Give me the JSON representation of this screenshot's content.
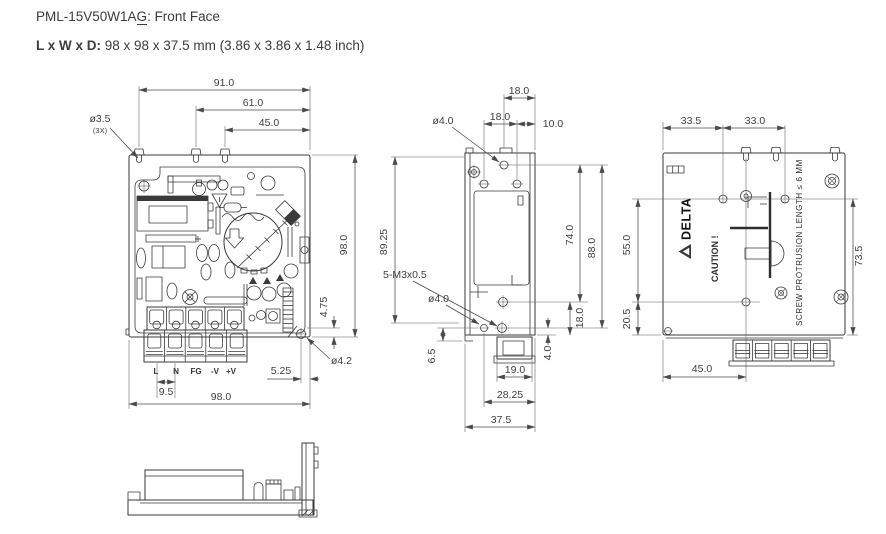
{
  "header": {
    "model": "PML-15V50W1A",
    "model_suffix": "G",
    "title_rest": ": Front Face",
    "size_label": "L x W x D:",
    "size_value": " 98 x 98 x 37.5 mm (3.86 x 3.86 x 1.48 inch)"
  },
  "front_view": {
    "dim_91": "91.0",
    "dim_61": "61.0",
    "dim_45": "45.0",
    "hole_note_dia": "ø3.5",
    "hole_note_qty": "(3X)",
    "dim_98_right": "98.0",
    "dim_4_75": "4.75",
    "hole_note_4_2": "ø4.2",
    "dim_5_25": "5.25",
    "dim_9_5": "9.5",
    "dim_98_bottom": "98.0",
    "terminals": [
      "L",
      "N",
      "FG",
      "-V",
      "+V"
    ]
  },
  "side_view": {
    "dim_18_top": "18.0",
    "hole_note_4_0_top": "ø4.0",
    "dim_18_mid": "18.0",
    "dim_10": "10.0",
    "dim_89_25": "89.25",
    "thread_note": "5-M3x0.5",
    "hole_note_4_0_bottom": "ø4.0",
    "dim_6_5": "6.5",
    "dim_74": "74.0",
    "dim_88": "88.0",
    "dim_18_right": "18.0",
    "dim_4_0": "4.0",
    "dim_19": "19.0",
    "dim_28_25": "28.25",
    "dim_37_5": "37.5"
  },
  "rear_view": {
    "dim_33_5": "33.5",
    "dim_33_0": "33.0",
    "dim_55": "55.0",
    "dim_20_5": "20.5",
    "dim_73_5": "73.5",
    "dim_45": "45.0",
    "brand": "DELTA",
    "caution": "CAUTION !",
    "screw_note": "SCREW PROTRUSION LENGTH ≤ 6 MM"
  }
}
